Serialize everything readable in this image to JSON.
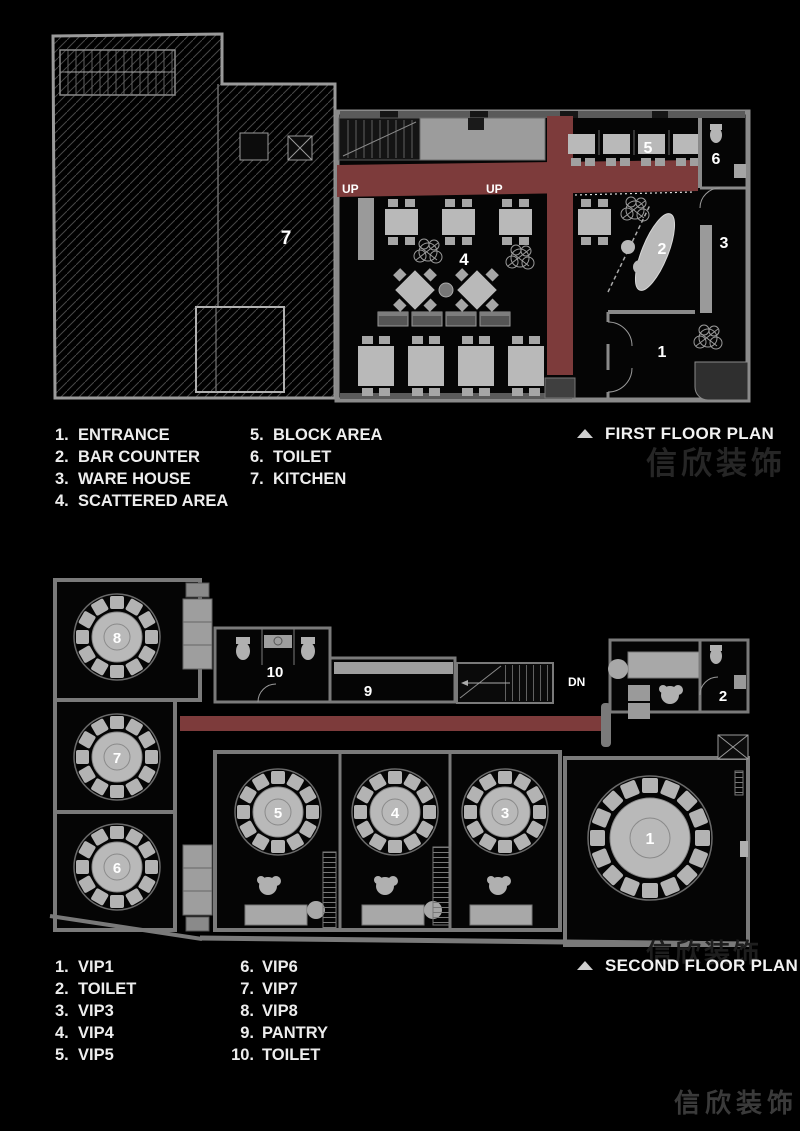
{
  "colors": {
    "corridor_red": "#7d3b3b",
    "furniture_gray": "#b9b9b9",
    "wall_gray": "#8a8a8a",
    "background": "#000000"
  },
  "watermark": {
    "text": "信欣装饰"
  },
  "first_floor": {
    "title": "FIRST FLOOR PLAN",
    "plan_labels": {
      "up_left": "UP",
      "up_center": "UP",
      "kitchen": "7",
      "scattered_area": "4",
      "block_area": "5",
      "toilet": "6",
      "bar_counter": "2",
      "ware_house": "3",
      "entrance": "1"
    },
    "legend_col1": [
      {
        "num": "1.",
        "label": "ENTRANCE"
      },
      {
        "num": "2.",
        "label": "BAR COUNTER"
      },
      {
        "num": "3.",
        "label": "WARE HOUSE"
      },
      {
        "num": "4.",
        "label": "SCATTERED AREA"
      }
    ],
    "legend_col2": [
      {
        "num": "5.",
        "label": "BLOCK AREA"
      },
      {
        "num": "6.",
        "label": "TOILET"
      },
      {
        "num": "7.",
        "label": "KITCHEN"
      }
    ]
  },
  "second_floor": {
    "title": "SECOND FLOOR PLAN",
    "plan_labels": {
      "vip8": "8",
      "vip7": "7",
      "vip6": "6",
      "toilet10": "10",
      "pantry": "9",
      "down": "DN",
      "toilet2": "2",
      "vip5": "5",
      "vip4": "4",
      "vip3": "3",
      "vip1": "1"
    },
    "legend_col1": [
      {
        "num": "1.",
        "label": "VIP1"
      },
      {
        "num": "2.",
        "label": "TOILET"
      },
      {
        "num": "3.",
        "label": "VIP3"
      },
      {
        "num": "4.",
        "label": "VIP4"
      },
      {
        "num": "5.",
        "label": "VIP5"
      }
    ],
    "legend_col2": [
      {
        "num": "6.",
        "label": "VIP6"
      },
      {
        "num": "7.",
        "label": "VIP7"
      },
      {
        "num": "8.",
        "label": "VIP8"
      },
      {
        "num": "9.",
        "label": "PANTRY"
      },
      {
        "num": "10.",
        "label": "TOILET"
      }
    ]
  }
}
